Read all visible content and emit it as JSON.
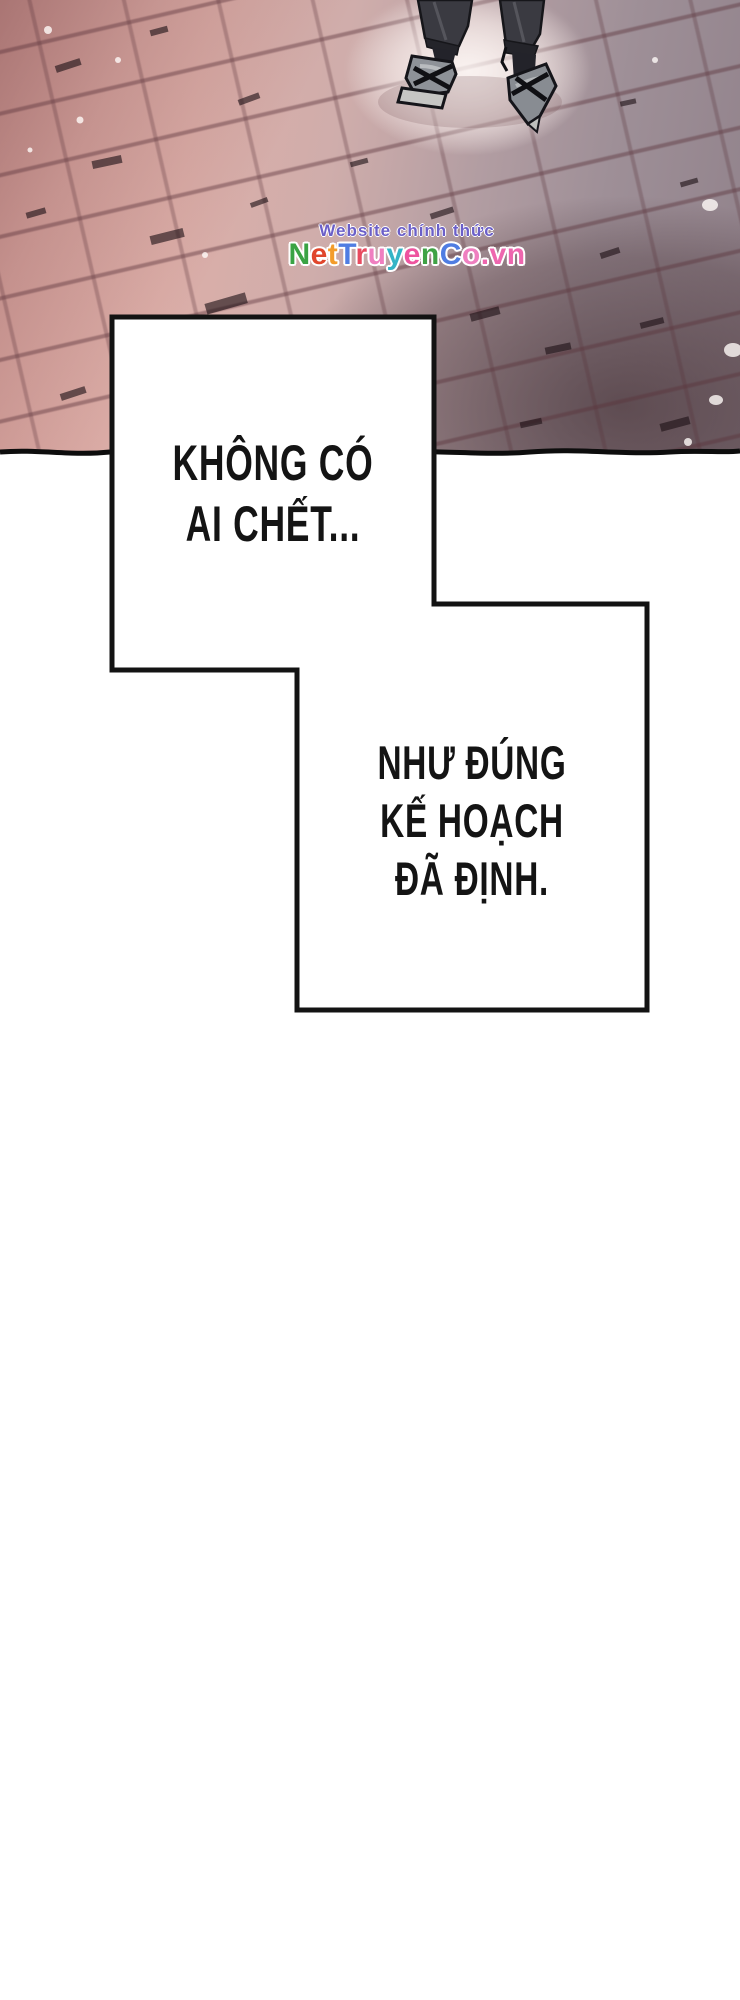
{
  "page": {
    "width": 740,
    "height": 2000,
    "background": "#ffffff"
  },
  "artwork": {
    "alt": "overhead view of a character's legs in dark trousers and grey sandals standing on diagonal brick pavement, pink-red at left fading to dark maroon at bottom right, light glow around the feet, torn black edge at bottom",
    "colors": {
      "brick_pink": "#dcaea8",
      "brick_mauve": "#9e8f97",
      "brick_dark_corner": "#5f4347",
      "mortar": "#5a323a",
      "glow": "#faf2f0",
      "pants": "#3a3a41",
      "sandal": "#8e9298",
      "sole": "#c6c6c4",
      "edge_line": "#0d0d0d"
    }
  },
  "watermark": {
    "line1": "Website chính thức",
    "line1_color": "#6b5fc8",
    "site_name": "NetTruyenCo.vn",
    "letters": [
      {
        "ch": "N",
        "style": "color:#3aa344"
      },
      {
        "ch": "e",
        "style": "color:#e0462c"
      },
      {
        "ch": "t",
        "style": "color:#f39c2b"
      },
      {
        "ch": "T",
        "style": "color:#4f7de2"
      },
      {
        "ch": "r",
        "style": "color:#e84a5f"
      },
      {
        "ch": "u",
        "style": "color:#ef7fc0"
      },
      {
        "ch": "y",
        "style": "color:#35b4c6"
      },
      {
        "ch": "e",
        "style": "color:#ee549f"
      },
      {
        "ch": "n",
        "style": "color:#3fa245"
      },
      {
        "ch": "C",
        "style": "color:#4f7de2"
      },
      {
        "ch": "o",
        "style": "color:#ef7fc0"
      },
      {
        "ch": ".",
        "style": "color:#ee66ae"
      },
      {
        "ch": "v",
        "style": "color:#ee66ae"
      },
      {
        "ch": "n",
        "style": "color:#ee66ae"
      }
    ]
  },
  "speech": {
    "border_color": "#131313",
    "fill_color": "#ffffff",
    "text_color": "#141414",
    "boxes": [
      {
        "lines": [
          "KHÔNG CÓ",
          "AI CHẾT..."
        ]
      },
      {
        "lines": [
          "NHƯ ĐÚNG",
          "KẾ HOẠCH",
          "ĐÃ ĐỊNH."
        ]
      }
    ]
  }
}
